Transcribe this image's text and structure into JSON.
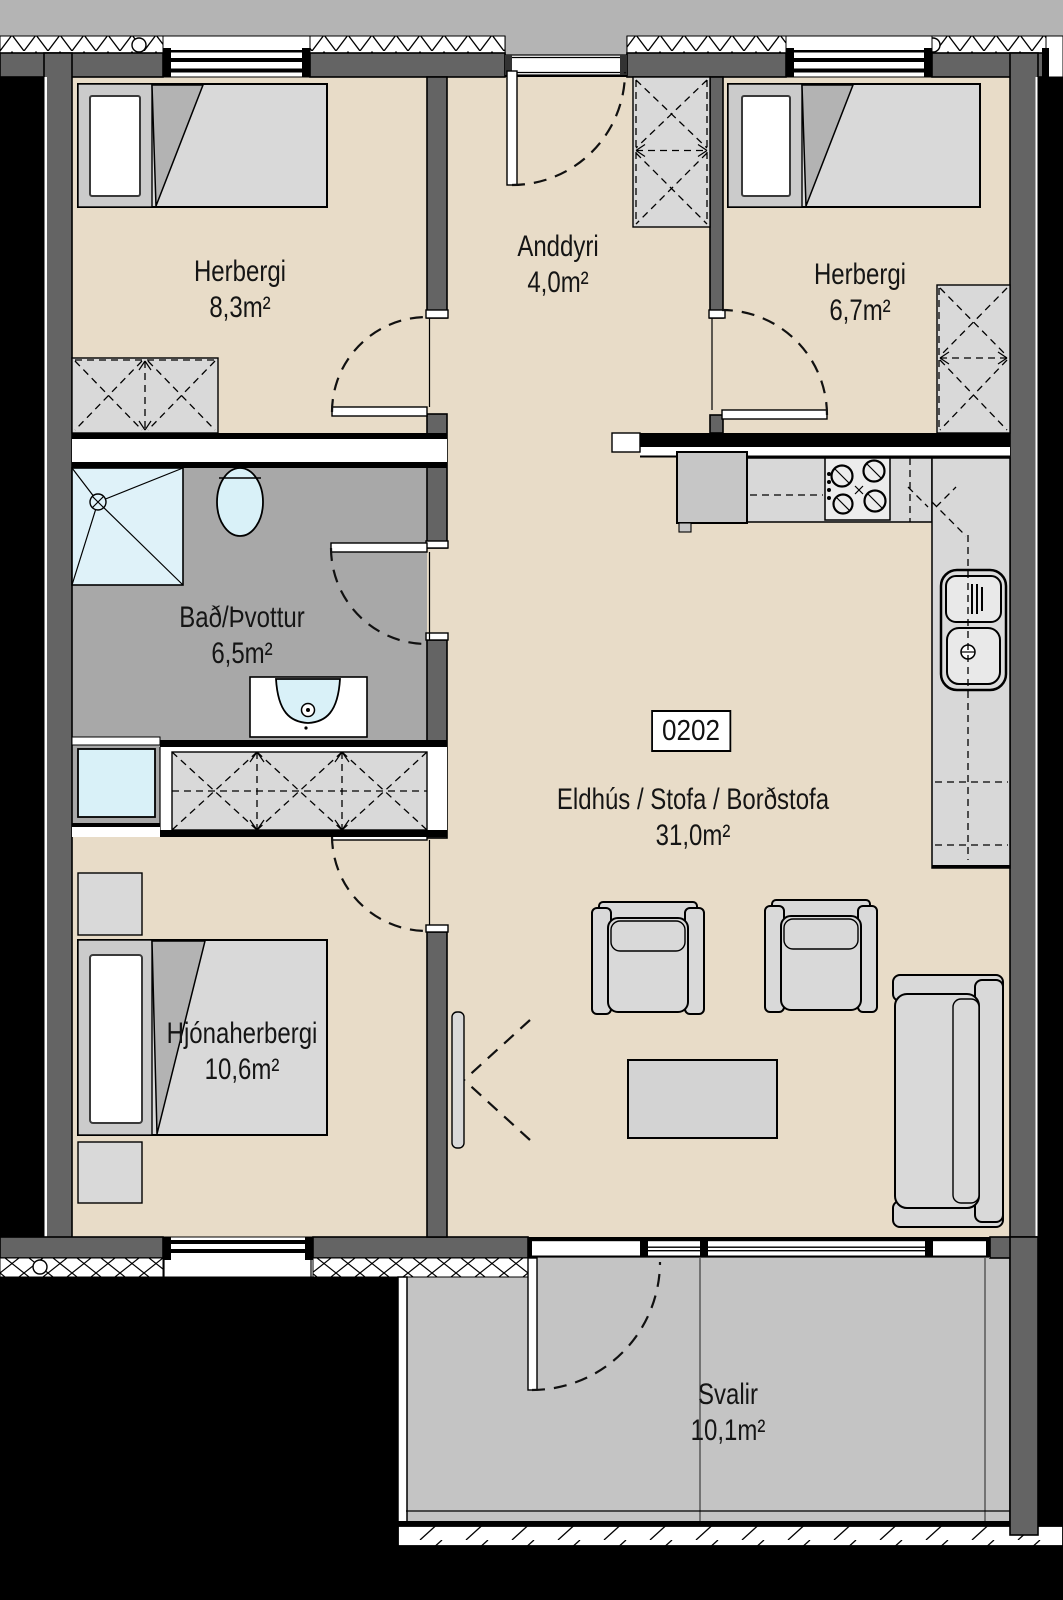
{
  "plan": {
    "unit_label": "0202",
    "rooms": {
      "bedroom_top_left": {
        "name": "Herbergi",
        "area": "8,3m²"
      },
      "entry_hall": {
        "name": "Anddyri",
        "area": "4,0m²"
      },
      "bedroom_top_right": {
        "name": "Herbergi",
        "area": "6,7m²"
      },
      "bathroom_laundry": {
        "name": "Bað/Þvottur",
        "area": "6,5m²"
      },
      "kitchen_living_dining": {
        "name": "Eldhús / Stofa / Borðstofa",
        "area": "31,0m²"
      },
      "master_bedroom": {
        "name": "Hjónaherbergi",
        "area": "10,6m²"
      },
      "balcony": {
        "name": "Svalir",
        "area": "10,1m²"
      }
    },
    "colors": {
      "background": "#000000",
      "exterior": "#b4b4b4",
      "wall": "#646464",
      "floor": "#e8dcc8",
      "wet_room_floor": "#a8a8a8",
      "balcony_floor": "#c4c4c4",
      "furniture": "#d9d9d9",
      "fixture_blue": "#d9f1f8"
    }
  }
}
